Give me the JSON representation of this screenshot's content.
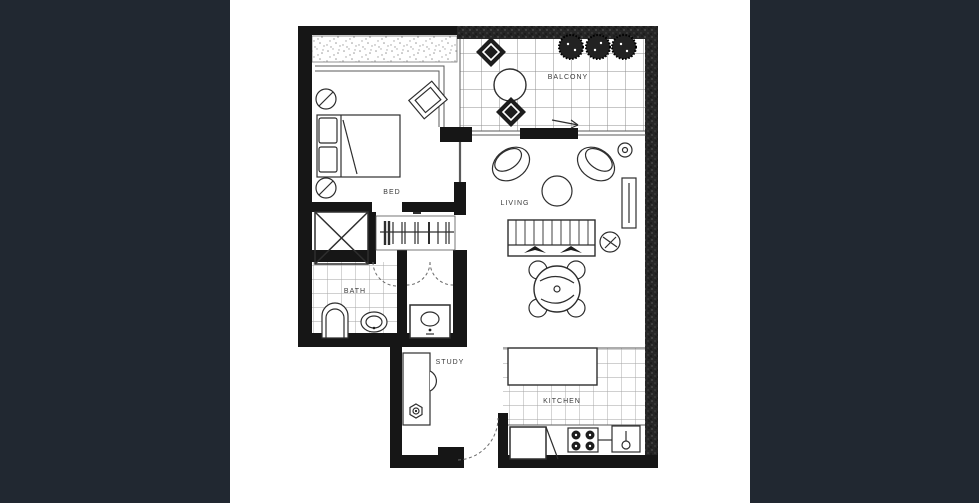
{
  "colors": {
    "sidebar": "#212831",
    "paper": "#ffffff",
    "wall": "#161616",
    "line": "#2e2e2e",
    "grid": "#8f8f8f",
    "label": "#3a3a3a"
  },
  "floorplan": {
    "type": "apartment-floor-plan",
    "labels": {
      "balcony": "BALCONY",
      "bed": "BED",
      "living": "LIVING",
      "bath": "BATH",
      "study": "STUDY",
      "kitchen": "KITCHEN"
    }
  }
}
